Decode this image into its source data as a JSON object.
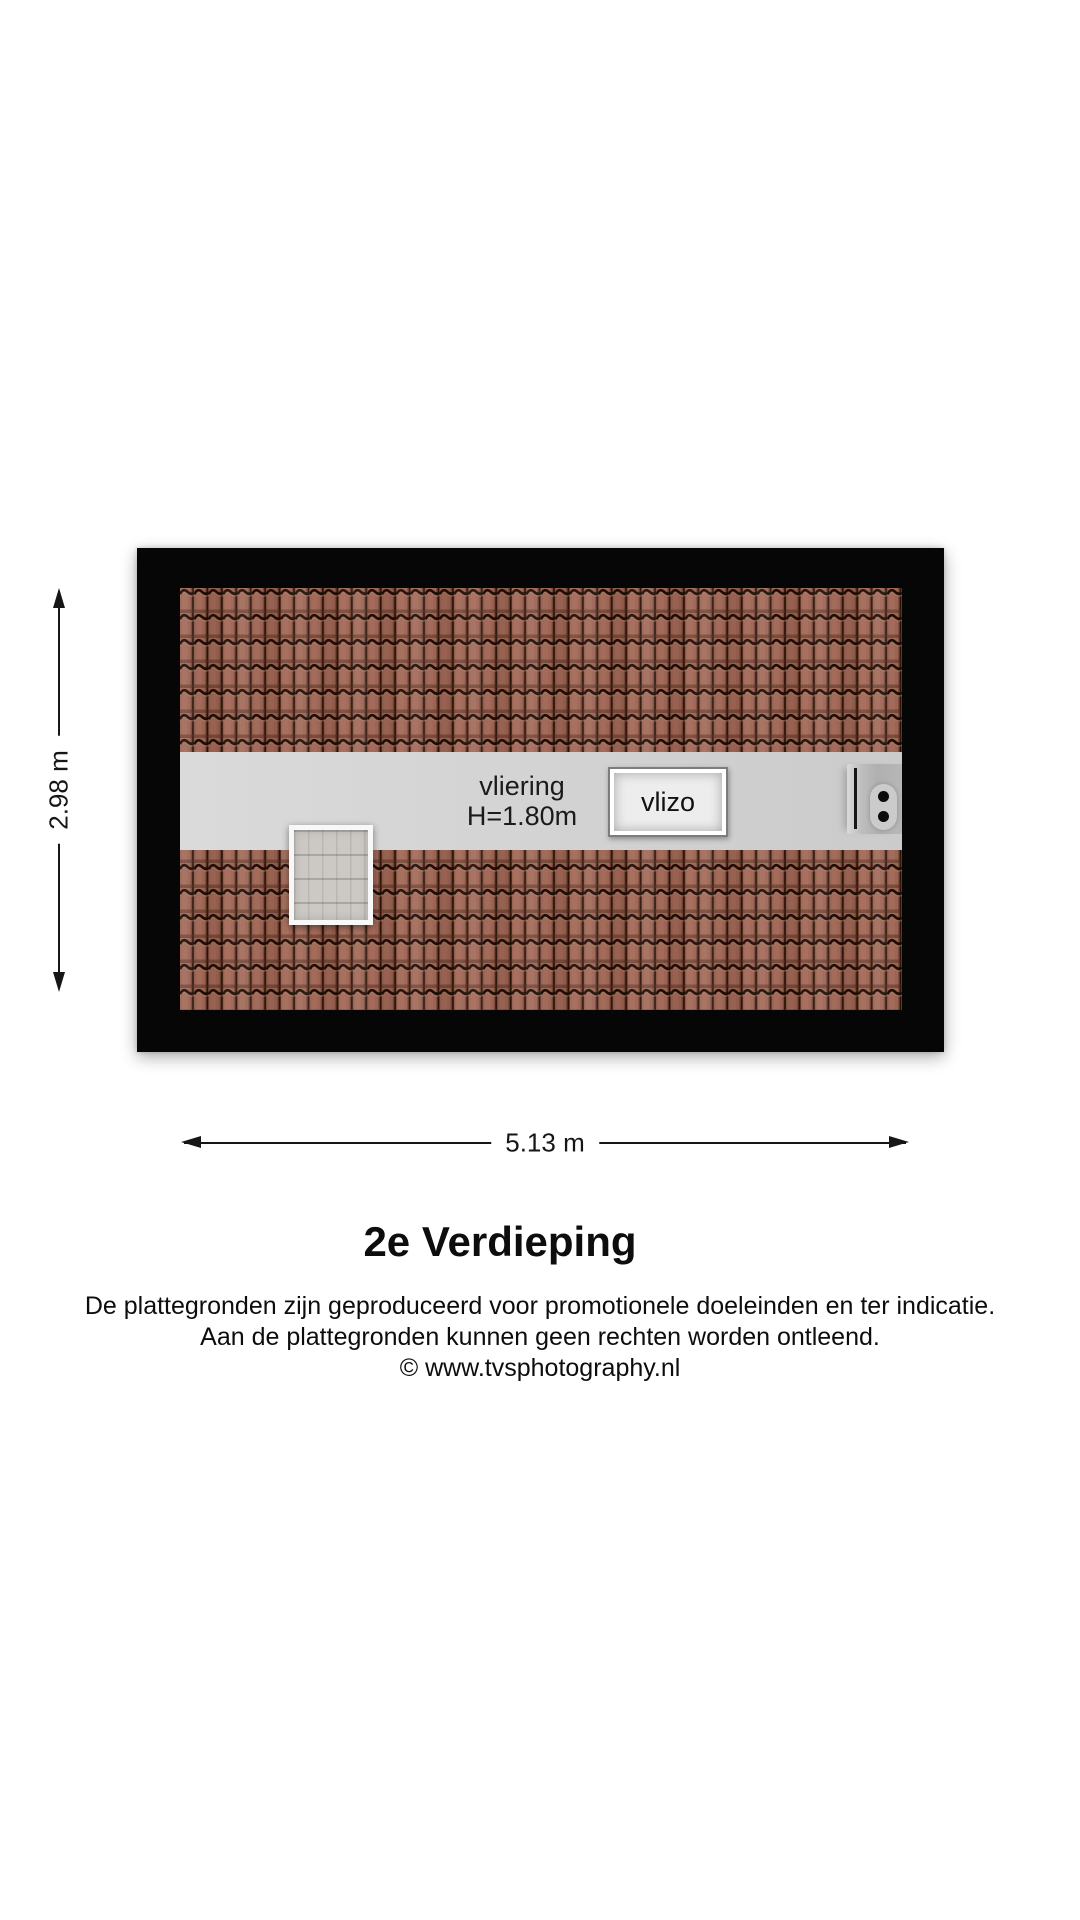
{
  "title": "2e Verdieping",
  "floorplan": {
    "room": {
      "name": "vliering",
      "height": "H=1.80m"
    },
    "hatch_label": "vlizo"
  },
  "dimensions": {
    "width": "5.13 m",
    "height": "2.98 m"
  },
  "disclaimer": {
    "line1": "De plattegronden zijn geproduceerd voor promotionele doeleinden en ter indicatie.",
    "line2": "Aan de plattegronden kunnen geen rechten worden ontleend.",
    "line3": "© www.tvsphotography.nl"
  },
  "colors": {
    "roof_tile": "#9c6454",
    "tile_groove": "#1d0d06",
    "loft_strip": "#d4d4d4",
    "frame": "#000000",
    "background": "#ffffff"
  }
}
